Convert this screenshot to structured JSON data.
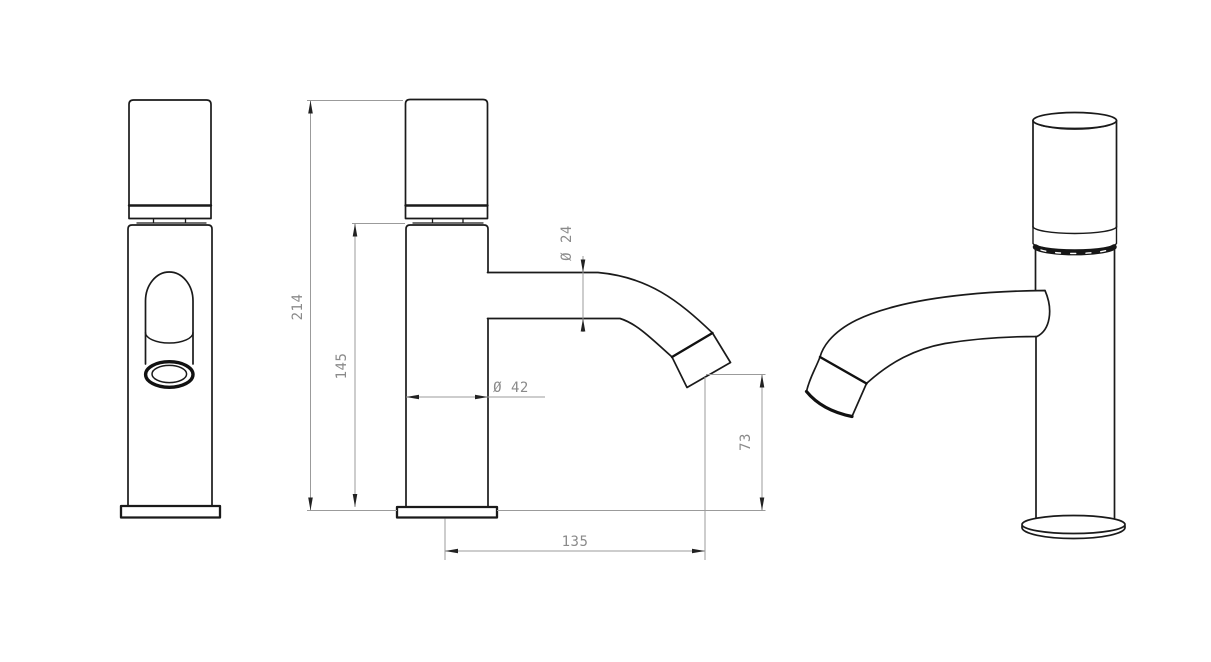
{
  "drawing": {
    "colors": {
      "outline": "#1a1a1a",
      "heavy_outline": "#111111",
      "dimension_line": "#9b9b9b",
      "dimension_text": "#8a8a8a",
      "background": "#ffffff"
    },
    "dimensions": {
      "overall_height": "214",
      "body_height": "145",
      "spout_diameter": "Ø 24",
      "body_diameter": "Ø 42",
      "outlet_height": "73",
      "spout_reach": "135"
    }
  }
}
